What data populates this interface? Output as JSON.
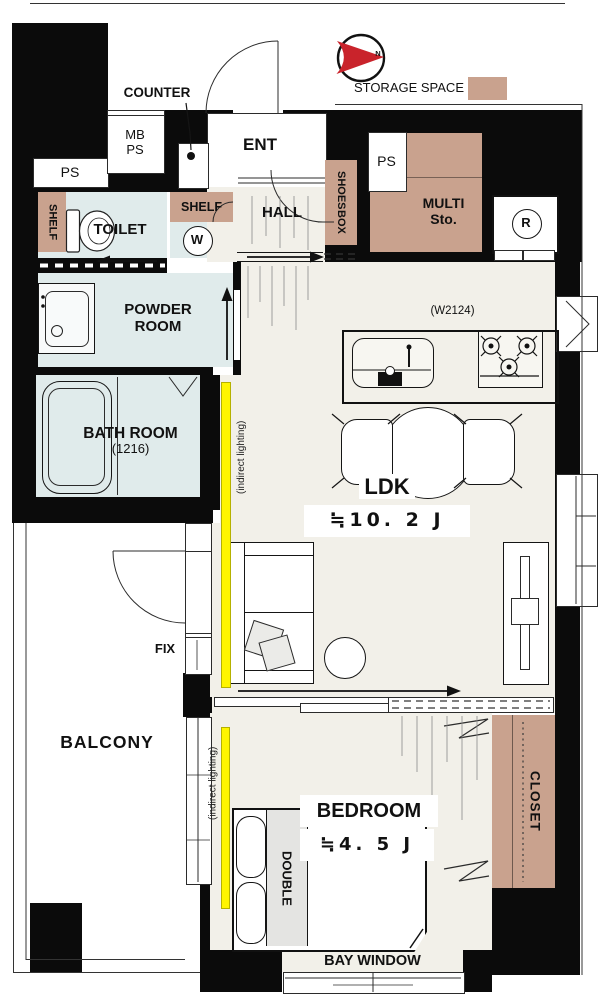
{
  "legend": {
    "storage_space": "STORAGE SPACE"
  },
  "compass": {
    "north": "N"
  },
  "entry": {
    "counter": "COUNTER",
    "mb_ps_line1": "MB",
    "mb_ps_line2": "PS",
    "ps_left": "PS",
    "ps_right": "PS",
    "ent": "ENT",
    "hall": "HALL",
    "shoes_box_line1": "SHOES",
    "shoes_box_line2": "BOX",
    "multi_storage_line1": "MULTI",
    "multi_storage_line2": "Sto.",
    "refrigerator": "R"
  },
  "sanitary": {
    "toilet": "TOILET",
    "toilet_shelf": "SHELF",
    "laundry_shelf": "SHELF",
    "washer": "W",
    "powder_line1": "POWDER",
    "powder_line2": "ROOM",
    "bath_line1": "BATH ROOM",
    "bath_line2": "(1216)"
  },
  "ldk": {
    "name": "LDK",
    "size": "≒10. 2 J",
    "kitchen_width": "(W2124)",
    "indirect_lighting": "(indirect lighting)"
  },
  "bedroom": {
    "name": "BEDROOM",
    "size": "≒4. 5 J",
    "bed": "DOUBLE",
    "closet": "CLOSET",
    "indirect_lighting": "(indirect lighting)",
    "bay_window": "BAY WINDOW"
  },
  "balcony": {
    "name": "BALCONY",
    "fix_window": "FIX"
  },
  "colors": {
    "wall_black": "#0B0B0B",
    "storage_tan": "#C9A28E",
    "wet_area_blue": "#E0EBEB",
    "floor_cream": "#F2F0E9",
    "accent_yellow": "#FFF500",
    "compass_red": "#C9232B",
    "bed_gray": "#E4E4E2"
  }
}
